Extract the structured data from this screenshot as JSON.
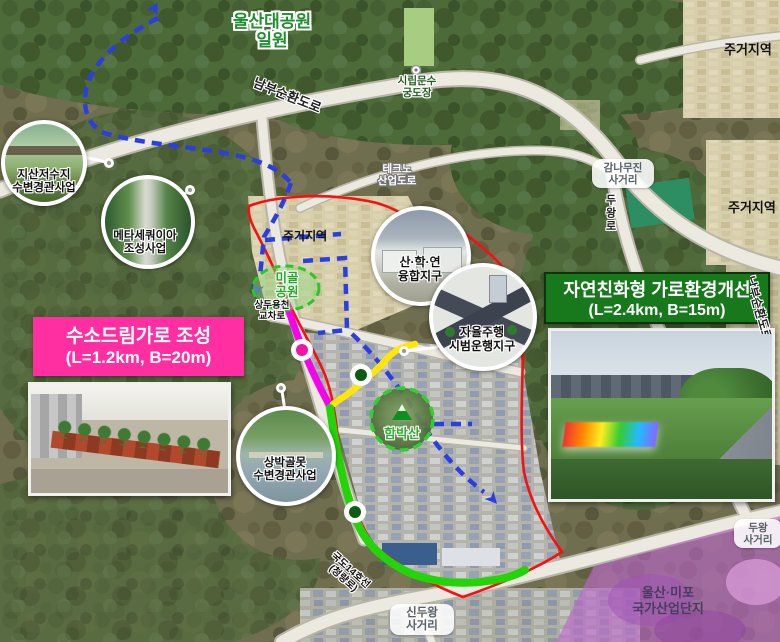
{
  "regions": {
    "park": {
      "line1": "울산대공원",
      "line2": "일원"
    },
    "residential_top_right": "주거지역",
    "residential_right": "주거지역",
    "residential_center": "주거지역",
    "industrial": {
      "line1": "울산·미포",
      "line2": "국가산업단지"
    }
  },
  "roads": {
    "nambu": "남부순환도로",
    "nambu_right": "남부순환도로",
    "techno": {
      "line1": "테크노",
      "line2": "산업도로"
    },
    "duwang": "두왕로",
    "gukdo14": {
      "line1": "국도14호선",
      "line2": "(청량로)"
    }
  },
  "pois": {
    "archery": {
      "line1": "시립문수",
      "line2": "궁도장"
    },
    "migol": {
      "line1": "미골",
      "line2": "공원"
    },
    "sangdu": {
      "line1": "상두용천",
      "line2": "교차로"
    },
    "hambak": "함박산"
  },
  "intersections": {
    "gamnamu": {
      "line1": "감나무진",
      "line2": "사거리"
    },
    "sinduwang": {
      "line1": "신두왕",
      "line2": "사거리"
    },
    "duwang": {
      "line1": "두왕",
      "line2": "사거리"
    }
  },
  "callouts": {
    "jisan": {
      "line1": "지산저수지",
      "line2": "수변경관사업"
    },
    "meta": {
      "line1": "메타세쿼이아",
      "line2": "조성사업"
    },
    "sanhak": {
      "line1": "산·학·연",
      "line2": "융합지구"
    },
    "auto": {
      "line1": "자율주행",
      "line2": "시범운행지구"
    },
    "sangbak": {
      "line1": "상박골못",
      "line2": "수변경관사업"
    }
  },
  "projects": {
    "hydrogen": {
      "title": "수소드림가로 조성",
      "spec": "(L=1.2km, B=20m)"
    },
    "eco": {
      "title": "자연친화형 가로환경개선",
      "spec": "(L=2.4km, B=15m)"
    }
  },
  "colors": {
    "hydrogen_box": "#ff2fa2",
    "eco_box": "#17781c",
    "district_boundary": "#f51111",
    "planned_route": "#2b3fe0",
    "hydrogen_route": "#f304e9",
    "link_route": "#ffe607",
    "eco_route": "#23d408",
    "industrial_overlay": "#bb66cc"
  }
}
